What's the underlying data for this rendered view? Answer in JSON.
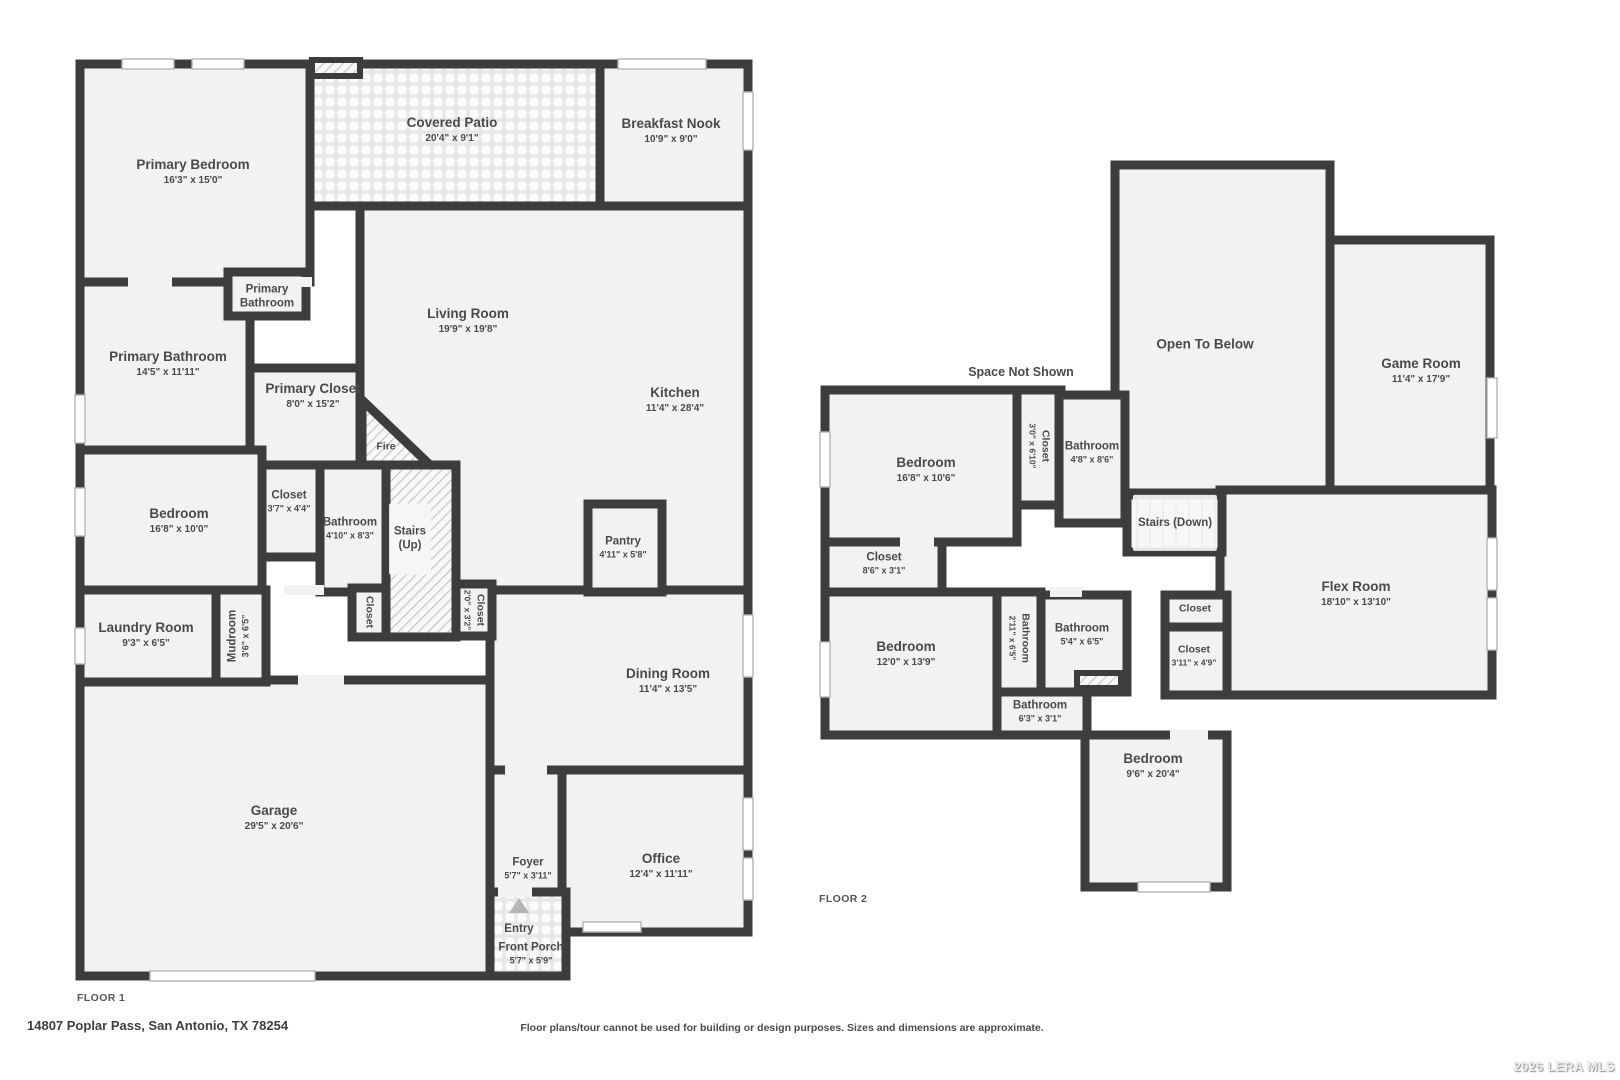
{
  "page": {
    "floor1_label": "FLOOR 1",
    "floor2_label": "FLOOR 2",
    "address": "14807 Poplar Pass, San Antonio, TX 78254",
    "disclaimer": "Floor plans/tour cannot be used for building or design purposes. Sizes and dimensions are approximate.",
    "credit": "2026 LERA MLS",
    "space_not_shown": "Space Not Shown"
  },
  "colors": {
    "wall": "#3d3d3d",
    "room_fill": "#f2f2f2",
    "label_text": "#4a4a4a"
  },
  "floor1": {
    "primary_bedroom": {
      "name": "Primary Bedroom",
      "dims": "16'3\" x 15'0\""
    },
    "covered_patio": {
      "name": "Covered Patio",
      "dims": "20'4\" x 9'1\""
    },
    "breakfast_nook": {
      "name": "Breakfast Nook",
      "dims": "10'9\" x 9'0\""
    },
    "living_room": {
      "name": "Living Room",
      "dims": "19'9\" x 19'8\""
    },
    "kitchen": {
      "name": "Kitchen",
      "dims": "11'4\" x 28'4\""
    },
    "primary_bath_wc": {
      "name": "Primary\nBathroom"
    },
    "primary_bathroom": {
      "name": "Primary Bathroom",
      "dims": "14'5\" x 11'11\""
    },
    "primary_closet": {
      "name": "Primary Closet",
      "dims": "8'0\" x 15'2\""
    },
    "fire": {
      "name": "Fire"
    },
    "bedroom": {
      "name": "Bedroom",
      "dims": "16'8\" x 10'0\""
    },
    "closet_a": {
      "name": "Closet",
      "dims": "3'7\" x 4'4\""
    },
    "bathroom": {
      "name": "Bathroom",
      "dims": "4'10\" x 8'3\""
    },
    "stairs_up": {
      "name": "Stairs\n(Up)"
    },
    "closet_b": {
      "name": "Closet"
    },
    "closet_c": {
      "name": "Closet",
      "dims": "2'0\" x 3'2\""
    },
    "pantry": {
      "name": "Pantry",
      "dims": "4'11\" x 5'8\""
    },
    "laundry_room": {
      "name": "Laundry Room",
      "dims": "9'3\" x 6'5\""
    },
    "mudroom": {
      "name": "Mudroom",
      "dims": "3'6\" x 6'5\""
    },
    "garage": {
      "name": "Garage",
      "dims": "29'5\" x 20'6\""
    },
    "dining_room": {
      "name": "Dining Room",
      "dims": "11'4\" x 13'5\""
    },
    "foyer": {
      "name": "Foyer",
      "dims": "5'7\" x 3'11\""
    },
    "office": {
      "name": "Office",
      "dims": "12'4\" x 11'11\""
    },
    "entry": {
      "name": "Entry"
    },
    "front_porch": {
      "name": "Front Porch",
      "dims": "5'7\" x 5'9\""
    }
  },
  "floor2": {
    "open_to_below": {
      "name": "Open To Below"
    },
    "game_room": {
      "name": "Game Room",
      "dims": "11'4\" x 17'9\""
    },
    "bedroom_a": {
      "name": "Bedroom",
      "dims": "16'8\" x 10'6\""
    },
    "closet_a": {
      "name": "Closet",
      "dims": "3'0\" x 6'10\""
    },
    "bathroom_a": {
      "name": "Bathroom",
      "dims": "4'8\" x 8'6\""
    },
    "stairs_down": {
      "name": "Stairs (Down)"
    },
    "closet_b": {
      "name": "Closet",
      "dims": "8'6\" x 3'1\""
    },
    "flex_room": {
      "name": "Flex Room",
      "dims": "18'10\" x 13'10\""
    },
    "closet_c": {
      "name": "Closet"
    },
    "closet_d": {
      "name": "Closet",
      "dims": "3'11\" x 4'9\""
    },
    "bedroom_b": {
      "name": "Bedroom",
      "dims": "12'0\" x 13'9\""
    },
    "bathroom_hall": {
      "name": "Bathroom",
      "dims": "2'11\" x 6'5\""
    },
    "bathroom_b": {
      "name": "Bathroom",
      "dims": "5'4\" x 6'5\""
    },
    "bathroom_c": {
      "name": "Bathroom",
      "dims": "6'3\" x 3'1\""
    },
    "bedroom_c": {
      "name": "Bedroom",
      "dims": "9'6\" x 20'4\""
    }
  }
}
